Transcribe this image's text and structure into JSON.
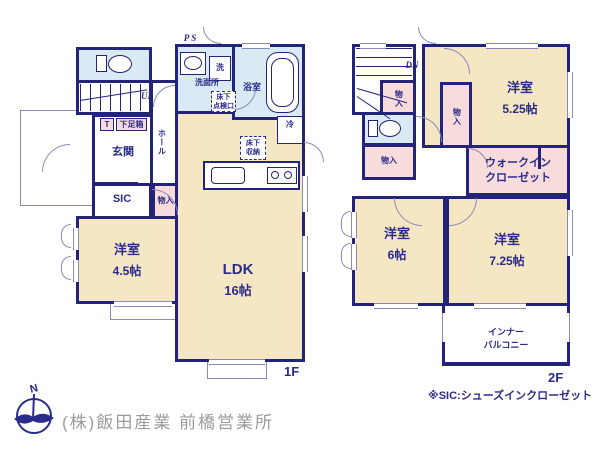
{
  "floor1": {
    "floor_label": "1F",
    "ps": "PS",
    "up": "UP",
    "laundry": "洗",
    "washroom": "洗面所",
    "inspection": [
      "床下",
      "点検口"
    ],
    "bath": "浴室",
    "t_box": "T",
    "shoe_box": "下足箱",
    "genkan": "玄関",
    "hall": "ホール",
    "sic": "SIC",
    "closet": "物入",
    "fridge": "冷",
    "underfloor": [
      "床下",
      "収納"
    ],
    "room45": {
      "name": "洋室",
      "size": "4.5帖"
    },
    "ldk": {
      "name": "LDK",
      "size": "16帖"
    }
  },
  "floor2": {
    "floor_label": "2F",
    "dn": "DN",
    "closet_a": "物入",
    "closet_b": "物入",
    "closet_c": "物入",
    "room525": {
      "name": "洋室",
      "size": "5.25帖"
    },
    "wic": [
      "ウォークイン",
      "クローゼット"
    ],
    "room6": {
      "name": "洋室",
      "size": "6帖"
    },
    "room725": {
      "name": "洋室",
      "size": "7.25帖"
    },
    "balcony": [
      "インナー",
      "バルコニー"
    ]
  },
  "footer": {
    "note": "※SIC:シューズインクローゼット",
    "company": "(株)飯田産業 前橋営業所",
    "compass_n": "N"
  },
  "colors": {
    "wall": "#23237a",
    "text": "#2b2b8a",
    "room_cream": "#f5e7c3",
    "closet_pink": "#f8dbdb",
    "wet_blue": "#d9eaf4",
    "thin_line": "#8a8ab8",
    "company_gray": "#9b9b9b"
  }
}
